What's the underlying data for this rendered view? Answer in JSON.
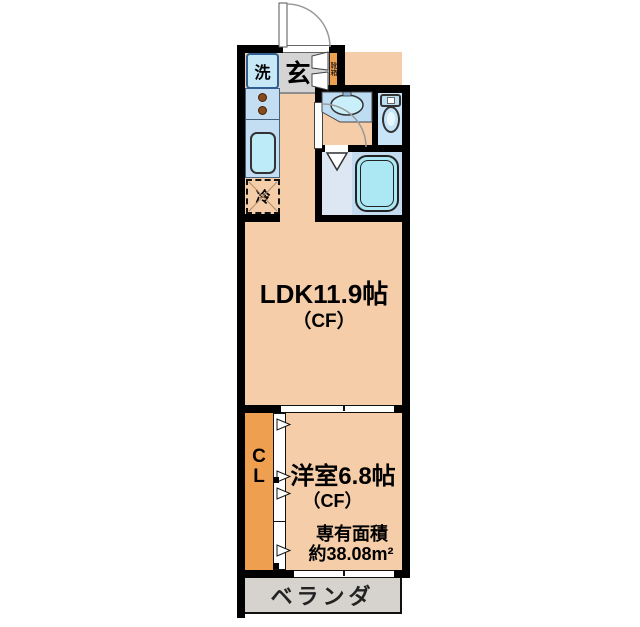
{
  "floorplan": {
    "type": "japanese-apartment-floorplan",
    "rooms": {
      "entrance": {
        "label": "玄"
      },
      "washer": {
        "label": "洗"
      },
      "shoe_box": {
        "label": "靴箱"
      },
      "fridge": {
        "label": "冷"
      },
      "ldk": {
        "name": "LDK11.9帖",
        "floor_note": "（CF）"
      },
      "bedroom": {
        "name": "洋室6.8帖",
        "floor_note": "（CF）"
      },
      "closet": {
        "letters": [
          "C",
          "L"
        ]
      },
      "balcony": {
        "label": "ベランダ"
      }
    },
    "area": {
      "line1": "専有面積",
      "line2": "約38.08m²"
    },
    "icons": [
      "entrance-door-arc",
      "shoe-cabinet-doors",
      "stove-burners",
      "kitchen-sink",
      "refrigerator-space",
      "washbasin-counter",
      "washbasin-door-arc",
      "toilet",
      "bathtub",
      "folding-bath-door",
      "closet-sliding-doors",
      "sliding-partition",
      "window-sill"
    ],
    "colors": {
      "wall": "#000000",
      "floor_peach": "#F5CDA9",
      "closet_orange": "#EE9F50",
      "kitchen_blue": "#C3DEF2",
      "fixture_cyan": "#BEEBF8",
      "toilet_floor": "#C9E3F7",
      "bath_floor": "#DDE7F4",
      "bathtub_zone": "#C2DBEF",
      "bathtub_fill": "#ACE8F3",
      "entrance_gray": "#D4D4D4",
      "balcony_gray": "#D6D3CE"
    }
  }
}
